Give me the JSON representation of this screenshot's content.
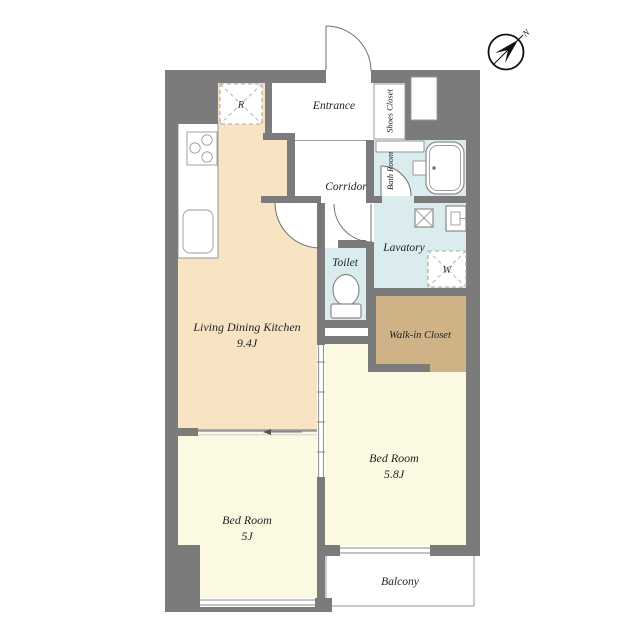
{
  "colors": {
    "wall": "#7b7b7b",
    "ldk": "#f8e4c3",
    "bedroom": "#fbf9e1",
    "water": "#daecee",
    "closet": "#cfb286",
    "label": "#1f1f1f"
  },
  "rooms": {
    "entrance": {
      "label": "Entrance"
    },
    "shoes_closet": {
      "label": "Shoes Closet"
    },
    "corridor": {
      "label": "Corridor"
    },
    "bath_room": {
      "label": "Bath Room"
    },
    "lavatory": {
      "label": "Lavatory"
    },
    "toilet": {
      "label": "Toilet"
    },
    "ldk": {
      "label": "Living Dining Kitchen",
      "size": "9.4J"
    },
    "walk_in_closet": {
      "label": "Walk-in Closet"
    },
    "bedroom_main": {
      "label": "Bed Room",
      "size": "5.8J"
    },
    "bedroom_second": {
      "label": "Bed Room",
      "size": "5J"
    },
    "balcony": {
      "label": "Balcony"
    }
  },
  "symbols": {
    "refrigerator": "R",
    "washing_machine": "W",
    "north": "N"
  }
}
